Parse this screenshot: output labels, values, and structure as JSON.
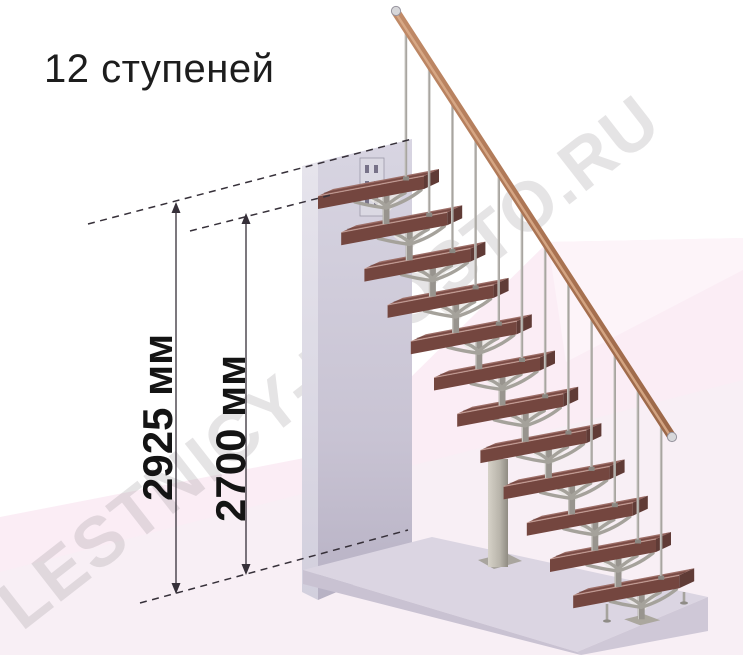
{
  "title": {
    "text": "12 ступеней"
  },
  "watermark": {
    "text": "LESTNICY-PROSTO.RU"
  },
  "dimensions": [
    {
      "id": "total-height",
      "label": "2925 мм"
    },
    {
      "id": "flight-height",
      "label": "2700 мм"
    }
  ],
  "staircase": {
    "steps_count": 12,
    "colors": {
      "wood_top": "#8d5b54",
      "wood_front": "#74463f",
      "wood_side": "#603b36",
      "metal": "#a5a29b",
      "handrail": "#aa7352",
      "wall": "#cfccdb",
      "slab": "#dbd5e2",
      "background_pink": "#fbedf5",
      "annotation": "#363039"
    }
  }
}
